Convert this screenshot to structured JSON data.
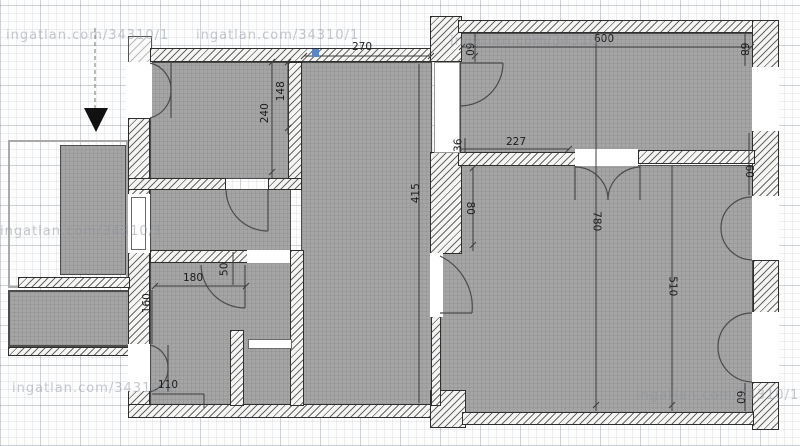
{
  "plan": {
    "watermark": "ingatlan.com/34310/1",
    "accent_marker_color": "#5b87c5",
    "room_fill": "#a5a5a5",
    "wall_stroke": "#2e2e2e"
  },
  "dims": [
    {
      "id": "center-room-width-top",
      "value": "270"
    },
    {
      "id": "left-room-height-a",
      "value": "148"
    },
    {
      "id": "left-room-height-b",
      "value": "240"
    },
    {
      "id": "center-room-height",
      "value": "415"
    },
    {
      "id": "mid-wall-depth",
      "value": "80"
    },
    {
      "id": "top-right-depth",
      "value": "60"
    },
    {
      "id": "top-right-width",
      "value": "600"
    },
    {
      "id": "top-right-corner",
      "value": "68"
    },
    {
      "id": "lower-offset",
      "value": "36"
    },
    {
      "id": "lower-width",
      "value": "227"
    },
    {
      "id": "right-wall-segment",
      "value": "60"
    },
    {
      "id": "right-room-total-height",
      "value": "780"
    },
    {
      "id": "right-room-height",
      "value": "510"
    },
    {
      "id": "bottom-right-segment",
      "value": "60"
    },
    {
      "id": "bath-width",
      "value": "180"
    },
    {
      "id": "bath-offset",
      "value": "50"
    },
    {
      "id": "balcony-height",
      "value": "160"
    },
    {
      "id": "bath-door-width",
      "value": "110"
    }
  ]
}
